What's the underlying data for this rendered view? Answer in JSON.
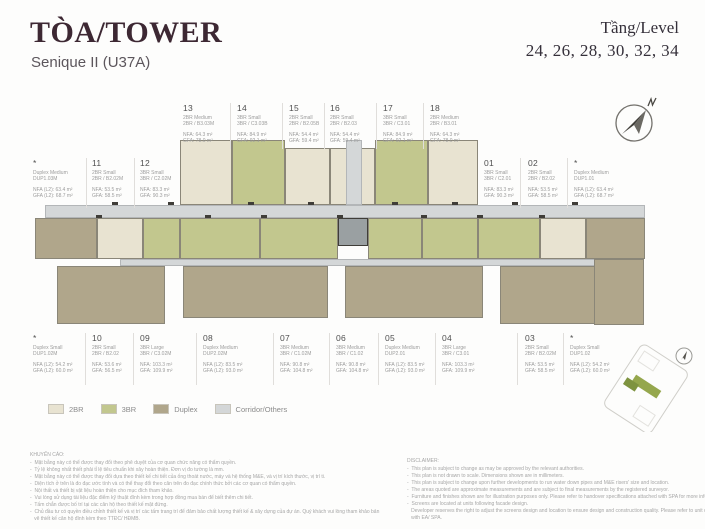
{
  "header": {
    "title": "TÒA/TOWER",
    "subtitle": "Senique II (U37A)",
    "level_label": "Tầng/Level",
    "levels": "24, 26, 28, 30, 32, 34"
  },
  "colors": {
    "title": "#3d2833",
    "wall": "#3f3d38",
    "text_muted": "#9c9c9c"
  },
  "legend": {
    "items": [
      {
        "label": "2BR",
        "color": "#e8e3d1"
      },
      {
        "label": "3BR",
        "color": "#c2c78e"
      },
      {
        "label": "Duplex",
        "color": "#b0a68b"
      },
      {
        "label": "Corridor/Others",
        "color": "#d4d7d8"
      }
    ]
  },
  "units": {
    "top": [
      {
        "num": "13",
        "line1": "2BR Medium",
        "line2": "2BR / B3.03M",
        "nfa": "NFA: 64.3 m²",
        "gfa": "GFA: 78.0 m²"
      },
      {
        "num": "14",
        "line1": "3BR Small",
        "line2": "3BR / C3.03B",
        "nfa": "NFA: 84.9 m²",
        "gfa": "GFA: 92.1 m²"
      },
      {
        "num": "15",
        "line1": "2BR Small",
        "line2": "2BR / B2.05B",
        "nfa": "NFA: 54.4 m²",
        "gfa": "GFA: 59.4 m²"
      },
      {
        "num": "16",
        "line1": "2BR Small",
        "line2": "2BR / B2.03",
        "nfa": "NFA: 54.4 m²",
        "gfa": "GFA: 59.4 m²"
      },
      {
        "num": "17",
        "line1": "3BR Small",
        "line2": "3BR / C3.01",
        "nfa": "NFA: 84.9 m²",
        "gfa": "GFA: 92.1 m²"
      },
      {
        "num": "18",
        "line1": "2BR Medium",
        "line2": "2BR / B3.01",
        "nfa": "NFA: 64.3 m²",
        "gfa": "GFA: 78.0 m²"
      }
    ],
    "left": [
      {
        "num": "*",
        "line1": "Duplex Medium",
        "line2": "DUP1.03M",
        "nfa": "NFA (L2): 63.4 m²",
        "gfa": "GFA (L2): 68.7 m²"
      },
      {
        "num": "11",
        "line1": "2BR Small",
        "line2": "2BR / B2.02M",
        "nfa": "NFA: 53.5 m²",
        "gfa": "GFA: 58.5 m²"
      },
      {
        "num": "12",
        "line1": "3BR Small",
        "line2": "3BR / C2.02M",
        "nfa": "NFA: 83.3 m²",
        "gfa": "GFA: 90.3 m²"
      }
    ],
    "right": [
      {
        "num": "01",
        "line1": "3BR Small",
        "line2": "3BR / C2.01",
        "nfa": "NFA: 83.3 m²",
        "gfa": "GFA: 90.3 m²"
      },
      {
        "num": "02",
        "line1": "2BR Small",
        "line2": "2BR / B2.02",
        "nfa": "NFA: 53.5 m²",
        "gfa": "GFA: 58.5 m²"
      },
      {
        "num": "*",
        "line1": "Duplex Medium",
        "line2": "DUP1.01",
        "nfa": "NFA (L2): 63.4 m²",
        "gfa": "GFA (L2): 68.7 m²"
      }
    ],
    "bottom": [
      {
        "num": "*",
        "line1": "Duplex Small",
        "line2": "DUP1.02M",
        "nfa": "NFA (L2): 54.2 m²",
        "gfa": "GFA (L2): 60.0 m²"
      },
      {
        "num": "10",
        "line1": "2BR Small",
        "line2": "2BR / B2.02",
        "nfa": "NFA: 53.6 m²",
        "gfa": "GFA: 56.5 m²"
      },
      {
        "num": "09",
        "line1": "3BR Large",
        "line2": "3BR / C3.02M",
        "nfa": "NFA: 103.3 m²",
        "gfa": "GFA: 109.9 m²"
      },
      {
        "num": "08",
        "line1": "Duplex Medium",
        "line2": "DUP2.02M",
        "nfa": "NFA (L2): 83.5 m²",
        "gfa": "GFA (L2): 93.0 m²"
      },
      {
        "num": "07",
        "line1": "3BR Medium",
        "line2": "3BR / C1.02M",
        "nfa": "NFA: 90.8 m²",
        "gfa": "GFA: 104.8 m²"
      },
      {
        "num": "06",
        "line1": "3BR Medium",
        "line2": "3BR / C1.02",
        "nfa": "NFA: 90.8 m²",
        "gfa": "GFA: 104.8 m²"
      },
      {
        "num": "05",
        "line1": "Duplex Medium",
        "line2": "DUP2.01",
        "nfa": "NFA (L2): 83.5 m²",
        "gfa": "GFA (L2): 93.0 m²"
      },
      {
        "num": "04",
        "line1": "3BR Large",
        "line2": "3BR / C3.01",
        "nfa": "NFA: 103.3 m²",
        "gfa": "GFA: 109.9 m²"
      },
      {
        "num": "03",
        "line1": "2BR Small",
        "line2": "2BR / B2.02M",
        "nfa": "NFA: 53.5 m²",
        "gfa": "GFA: 58.5 m²"
      },
      {
        "num": "*",
        "line1": "Duplex Small",
        "line2": "DUP1.02",
        "nfa": "NFA (L2): 54.2 m²",
        "gfa": "GFA (L2): 60.0 m²"
      }
    ]
  },
  "notes_vi": {
    "title": "KHUYẾN CÁO:",
    "lines": [
      "-  Mặt bằng này có thể được thay đổi theo phê duyệt của cơ quan chức năng có thẩm quyền.",
      "-  Tỷ lệ không nhất thiết phải tỉ lệ tiêu chuẩn khi xây hoàn thiện. Đơn vị đo tường là mm.",
      "-  Mặt bằng này có thể được thay đổi dựa theo thiết kế chi tiết của ống thoát nước, máy và hệ thống M&E, và vị trí kích thước, vị trí ti.",
      "-  Diện tích ở trên là đo đạc ước tính và có thể thay đổi theo căn trên đo đạc chính thức bởi các cơ quan có thẩm quyền.",
      "-  Nội thất và thiết bị vật liệu hoàn thiện cho mục đích tham khảo.",
      "-  Vui lòng sử dụng tài liệu đặc điểm kỹ thuật đính kèm trong hợp đồng mua bán để biết thêm chi tiết.",
      "-  Tấm chắn được bố trí tại các căn hộ theo thiết kế mặt đứng.",
      "-  Chủ đầu tư có quyền điều chỉnh thiết kế và vị trí các tấm trang trí để đảm bảo chất lượng thiết kế & xây dựng của dự án. Quý khách vui lòng tham khảo bản",
      "   vẽ thiết kế căn hộ đính kèm theo TTĐC/ HĐMB."
    ]
  },
  "notes_en": {
    "title": "DISCLAIMER:",
    "lines": [
      "-  This plan is subject to change as may be approved by the relevant authorities.",
      "-  This plan is not drawn to scale. Dimensions shown are in millimeters.",
      "-  This plan is subject to change upon further developments to run water down pipes and M&E risers' size and location.",
      "-  The areas quoted are approximate measurements and are subject to final measurements by the registered surveyor.",
      "-  Furniture and finishes shown are for illustration purposes only. Please refer to handover specifications attached with SPA for more information.",
      "-  Screens are located at units following facade design.",
      "   Developer reserves the right to adjust the screens design and location to ensure design and construction quality. Please refer to unit contract plan attached",
      "   with EA/ SPA."
    ]
  },
  "compass": {
    "label": "N"
  }
}
